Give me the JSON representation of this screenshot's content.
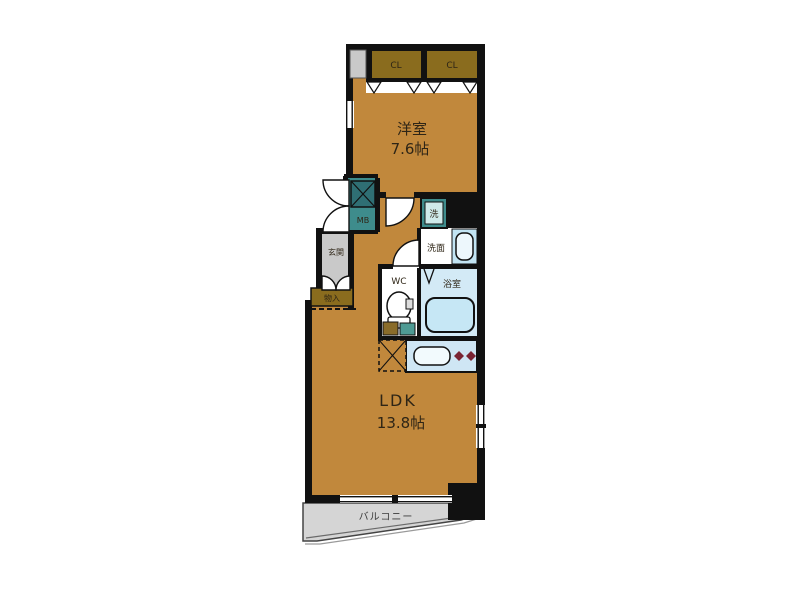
{
  "labels": {
    "western_room": "洋室",
    "western_room_size": "7.6帖",
    "ldk": "LDK",
    "ldk_size": "13.8帖",
    "closet_left": "CL",
    "closet_right": "CL",
    "balcony": "バルコニー",
    "entrance": "玄関",
    "storage": "物入",
    "meter_box": "MB",
    "washer_machine": "洗",
    "washroom": "洗面",
    "bathroom": "浴室",
    "wc": "WC"
  },
  "colors": {
    "floor_tan": "#c1883c",
    "closet_brown": "#8a6c1e",
    "wall_black": "#111111",
    "meter_teal": "#3e8c8c",
    "shaft_teal_dark": "#2f6f74",
    "entrance_gray": "#c9c9c9",
    "balcony_gray": "#d5d5d5",
    "bath_blue": "#d3eaf6",
    "counter_blue": "#cfe6f4",
    "fixture_blue": "#c2e4f3",
    "burner_maroon": "#7a2433"
  }
}
